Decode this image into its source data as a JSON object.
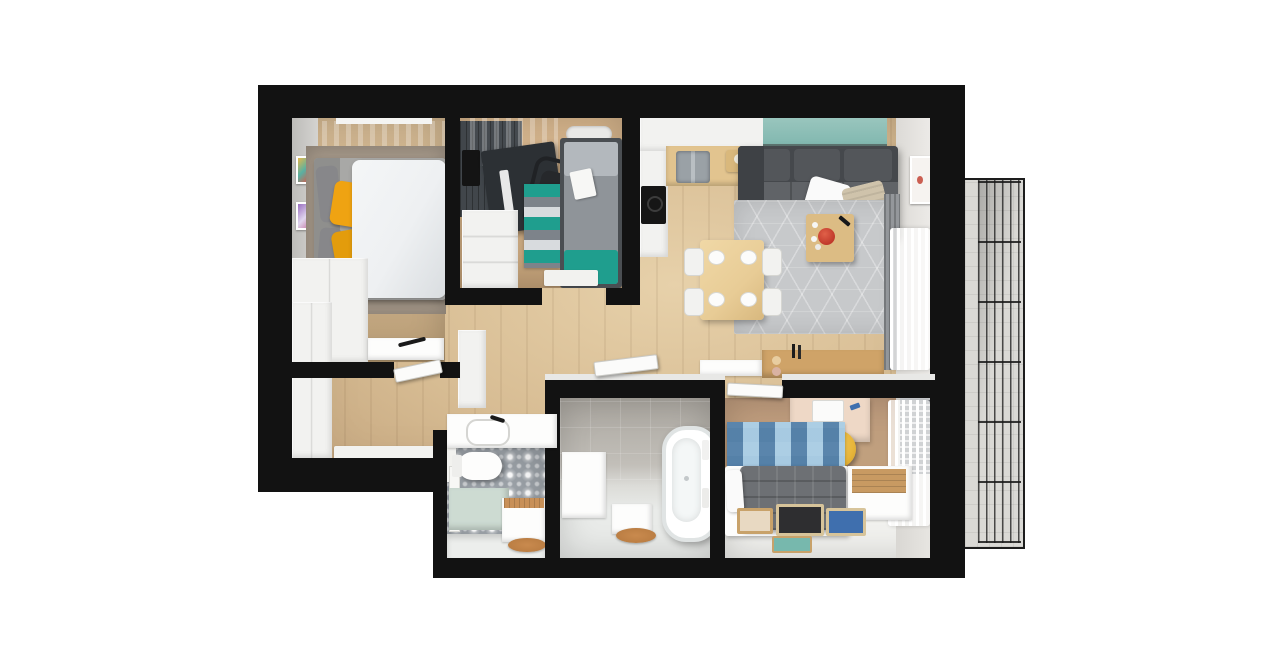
{
  "scene": {
    "title": "apartment-3d-floor-plan-render",
    "width_px": 1280,
    "height_px": 667,
    "view": "top-down-3d-render",
    "visible_text": []
  },
  "palette": {
    "page": "#ffffff",
    "wall": "#121212",
    "wood": "#d7bc93",
    "wood_light": "#e7d1aa",
    "wood_dark": "#c2a37c",
    "gray_wall": "#d4d3d0",
    "carpet": "#a59889",
    "bedroom_floor": "#c6ab86",
    "duvet": "#eef0f2",
    "bed_frame": "#a8a8a6",
    "yellow": "#efa312",
    "office_wall": "#41464b",
    "desk_dark": "#2c3034",
    "dresser": "#f1f1ef",
    "teal": "#1f9e8e",
    "office_bed": "#8f9499",
    "cabinet": "#f2f2f0",
    "counter_wood": "#e2c48f",
    "sink_steel": "#b9bfc3",
    "cooktop": "#161616",
    "teal_glass": "#82b8b0",
    "sofa_back": "#45484c",
    "sofa_seat": "#606367",
    "pillow_white": "#fafafa",
    "throw_beige": "#cfc3ab",
    "rug": "#c7c9cb",
    "table_wood": "#e8cc96",
    "coffee_wood": "#dcbc84",
    "red_accent": "#c0392b",
    "sideboard": "#cfa368",
    "wall_inner": "#eceae7",
    "curtain_gray": "#94979b",
    "tile_gray": "#aaa69f",
    "bath_floor": "#e9ebe9",
    "wc_tile": "#9aa0a6",
    "mint": "#cddbd2",
    "wood_lid": "#b5793f",
    "kids_wall": "#bd9a7c",
    "kids_floor": "#c29e7b",
    "kids_rug": "#f1f1ee",
    "quilt": "#6d7074",
    "chair_yellow": "#e7b63b",
    "desk_pink": "#eed8c6",
    "balcony_floor": "#dad9d5",
    "railing": "#1d1d1d",
    "mat_white": "#f2f2ef",
    "door_white": "#fbfbfa"
  },
  "rooms": [
    {
      "id": "bedroom-main",
      "name": "main bedroom",
      "position": "top-left",
      "furniture": [
        "double-bed-white-duvet",
        "yellow-pillows",
        "gray-headboard",
        "area-rug",
        "wardrobe",
        "console-desk-with-lamp",
        "two-wall-pictures",
        "window-blinds"
      ]
    },
    {
      "id": "office-bedroom",
      "name": "office / second bedroom",
      "position": "top-middle",
      "furniture": [
        "dark-desk",
        "office-chair",
        "single-bed-teal-throw",
        "zigzag-runner-rug",
        "white-dresser",
        "dark-accent-wall",
        "speaker",
        "wall-vent"
      ]
    },
    {
      "id": "kitchen-living",
      "name": "kitchen and living room",
      "position": "top-right",
      "furniture": [
        "l-shaped-kitchen-counter",
        "double-sink",
        "cooktop",
        "cutting-board",
        "teal-glass-panel",
        "gray-sofa",
        "white-pillow",
        "beige-throw",
        "hexagon-rug",
        "coffee-table-red-bowl",
        "dining-table-four-plates",
        "four-white-chairs",
        "wood-sideboard",
        "white-shelf",
        "wall-picture",
        "gray-curtain",
        "sheer-curtain"
      ]
    },
    {
      "id": "hallway",
      "name": "entrance hallway",
      "position": "left-middle",
      "furniture": [
        "white-wardrobe",
        "tall-cabinet",
        "entrance-mat",
        "open-door-leaf"
      ]
    },
    {
      "id": "wc",
      "name": "toilet room",
      "position": "bottom-left",
      "furniture": [
        "patterned-tile-floor",
        "wall-hung-toilet",
        "mint-bench",
        "washing-machine",
        "wood-lid-basket",
        "vanity-with-sink"
      ]
    },
    {
      "id": "bathroom",
      "name": "bathroom",
      "position": "bottom-middle",
      "furniture": [
        "freestanding-bathtub",
        "toilet",
        "wood-round-mat",
        "vanity-cabinet",
        "towels",
        "gray-wall-tiles"
      ]
    },
    {
      "id": "kids-bedroom",
      "name": "kids bedroom",
      "position": "bottom-right",
      "furniture": [
        "bed-gingham-headboard",
        "gray-quilt",
        "white-pillow",
        "study-desk",
        "yellow-chair",
        "toy-box",
        "play-mats",
        "window-blinds",
        "sheer-curtain"
      ]
    },
    {
      "id": "balcony",
      "name": "balcony",
      "position": "right-outside",
      "furniture": [
        "metal-railing-grid",
        "concrete-floor"
      ]
    }
  ]
}
